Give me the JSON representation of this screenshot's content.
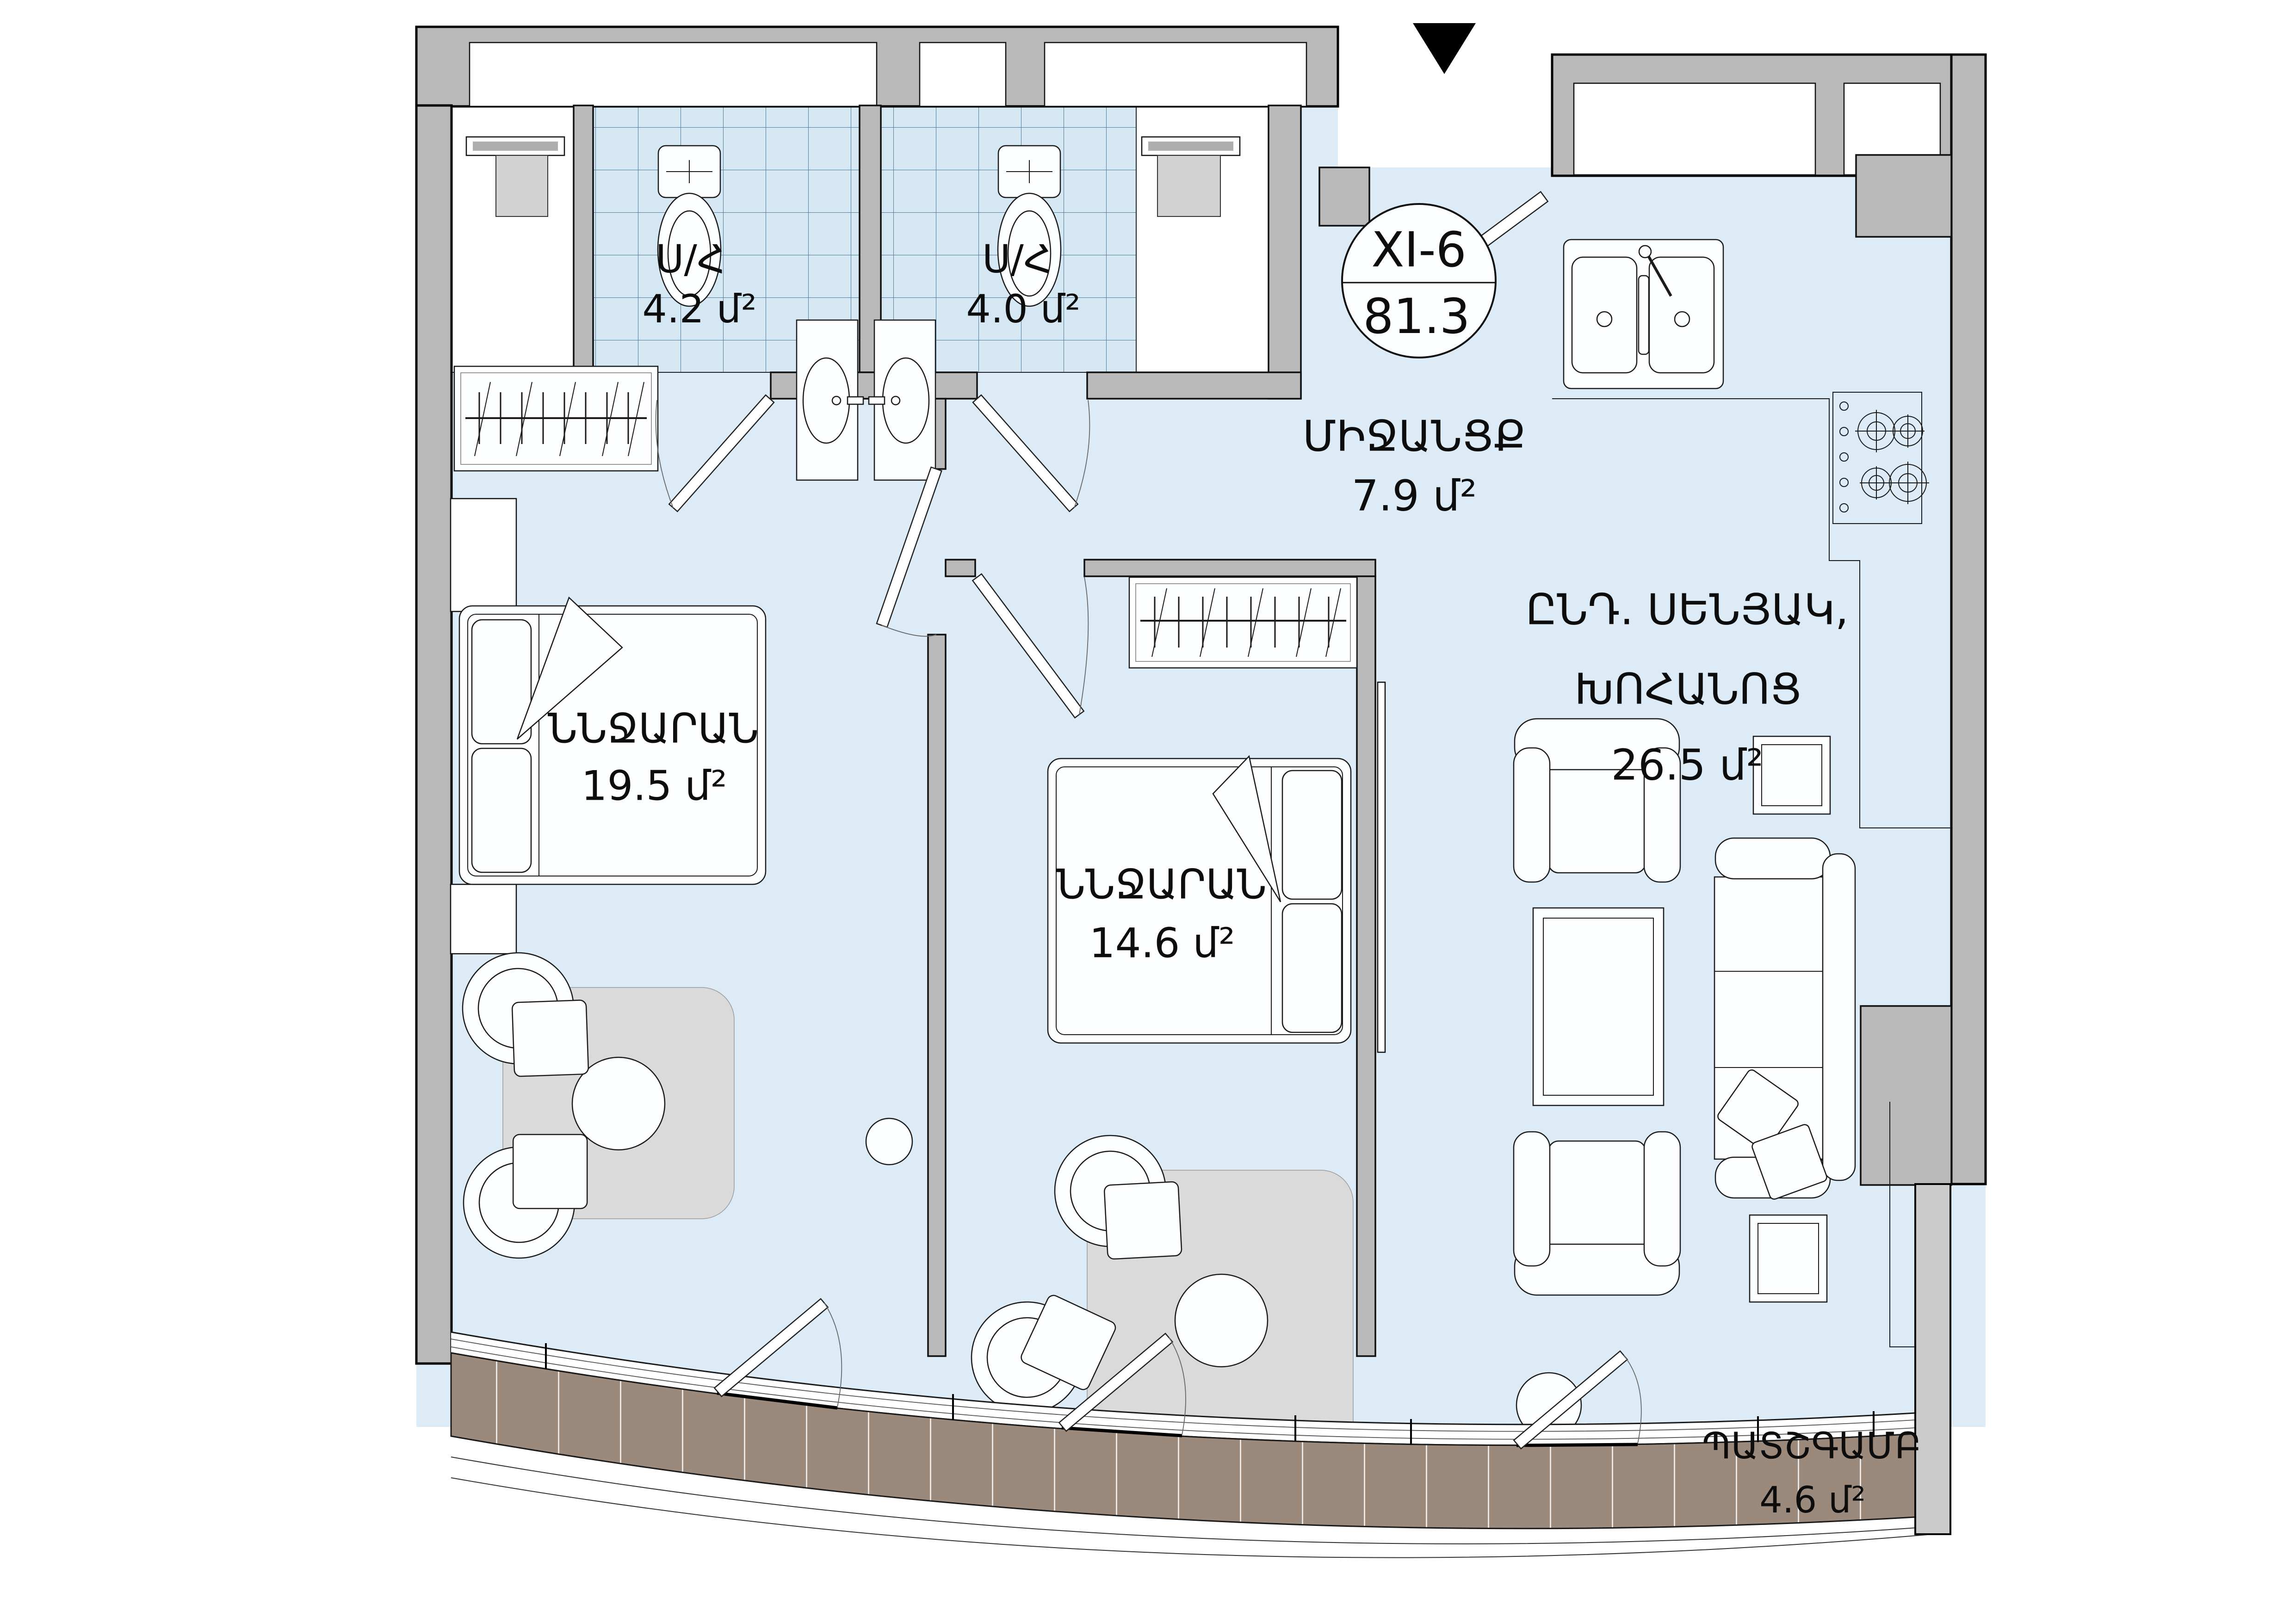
{
  "badge": {
    "unit": "XI-6",
    "total_area": "81.3"
  },
  "rooms": {
    "bathroom_1": {
      "name": "Ս/Հ",
      "area": "4.2 մ²"
    },
    "bathroom_2": {
      "name": "Ս/Հ",
      "area": "4.0 մ²"
    },
    "hallway": {
      "name": "ՄԻՋԱՆՑՔ",
      "area": "7.9 մ²"
    },
    "living_kitchen": {
      "name_line1": "ԸՆԴ. ՍԵՆՅԱԿ,",
      "name_line2": "ԽՈՀԱՆՈՑ",
      "area": "26.5 մ²"
    },
    "bedroom_1": {
      "name": "ՆՆՋԱՐԱՆ",
      "area": "19.5 մ²"
    },
    "bedroom_2": {
      "name": "ՆՆՋԱՐԱՆ",
      "area": "14.6 մ²"
    },
    "balcony": {
      "name": "ՊԱՏՇԳԱՄԲ",
      "area": "4.6 մ²"
    }
  },
  "colors": {
    "interior": "#dcebf5",
    "tile": "#d5e7f2",
    "tile_grid": "#4c7b9c",
    "wall": "#b9b9b9",
    "wall_light": "#cbcbcb",
    "deck": "#9b8a7b",
    "furniture": "#fcfeff",
    "rug": "#dadada"
  }
}
